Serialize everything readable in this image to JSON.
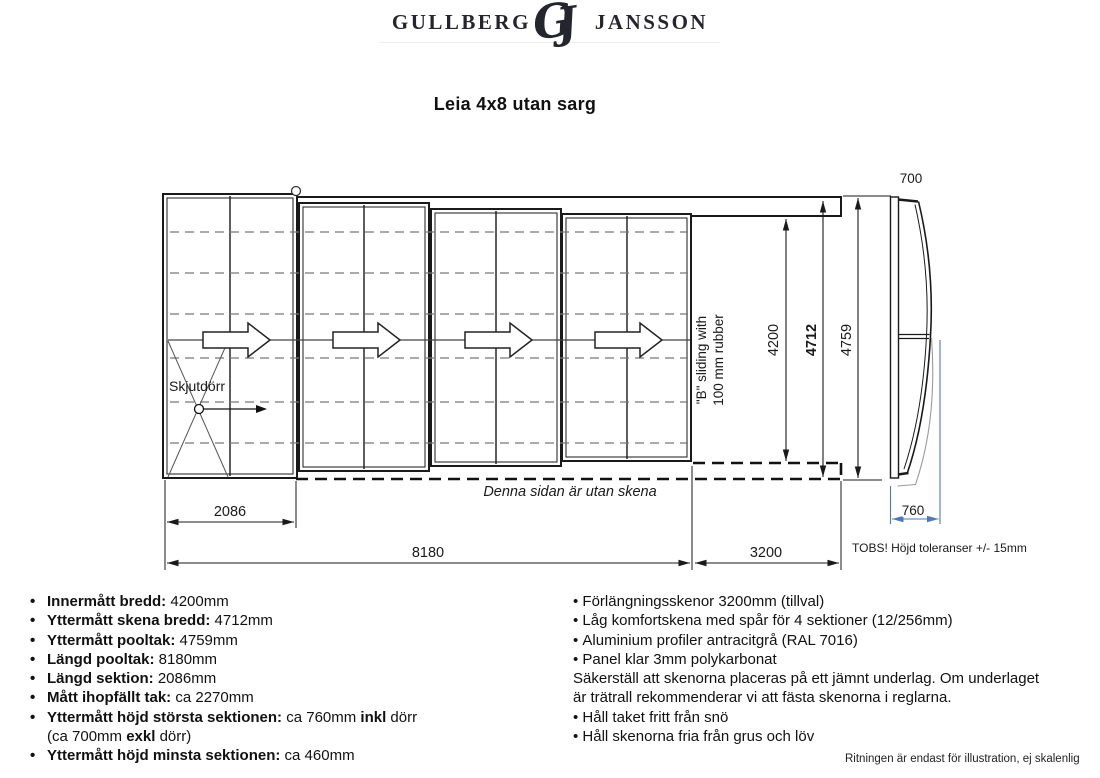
{
  "logo": {
    "word_left": "Gullberg",
    "monogram_g": "G",
    "monogram_j": "J",
    "word_right": "Jansson"
  },
  "title": "Leia 4x8 utan sarg",
  "drawing": {
    "labels": {
      "skjutdorr": "Skjutdörr",
      "denna_sidan": "Denna sidan är utan skena",
      "b_sliding_line1": "\"B\" sliding with",
      "b_sliding_line2": "100 mm rubber",
      "tobs": "TOBS! Höjd toleranser +/- 15mm"
    },
    "dimensions": {
      "inner_width": "4200",
      "rail_width": "4712",
      "outer_width": "4759",
      "section_length": "2086",
      "roof_length": "8180",
      "extension_length": "3200",
      "top_section_height": "700",
      "bottom_section_height": "760"
    },
    "colors": {
      "line": "#1a1a1a",
      "dash": "#777777",
      "blue": "#4d79b9",
      "gray": "#9a9a9a"
    }
  },
  "specs_left": [
    {
      "bullet": true,
      "segments": [
        {
          "t": "Innermått bredd:",
          "b": 1
        },
        {
          "t": " 4200mm"
        }
      ]
    },
    {
      "bullet": true,
      "segments": [
        {
          "t": "Yttermått skena bredd:",
          "b": 1
        },
        {
          "t": " 4712mm"
        }
      ]
    },
    {
      "bullet": true,
      "segments": [
        {
          "t": "Yttermått pooltak:",
          "b": 1
        },
        {
          "t": " 4759mm"
        }
      ]
    },
    {
      "bullet": true,
      "segments": [
        {
          "t": "Längd pooltak:",
          "b": 1
        },
        {
          "t": " 8180mm"
        }
      ]
    },
    {
      "bullet": true,
      "segments": [
        {
          "t": "Längd sektion:",
          "b": 1
        },
        {
          "t": " 2086mm"
        }
      ]
    },
    {
      "bullet": true,
      "segments": [
        {
          "t": "Mått ihopfällt tak:",
          "b": 1
        },
        {
          "t": " ca 2270mm"
        }
      ]
    },
    {
      "bullet": true,
      "segments": [
        {
          "t": "Yttermått höjd största sektionen:",
          "b": 1
        },
        {
          "t": " ca 760mm "
        },
        {
          "t": "inkl",
          "b": 1
        },
        {
          "t": " dörr"
        },
        {
          "br": 1
        },
        {
          "t": "(ca 700mm "
        },
        {
          "t": "exkl",
          "b": 1
        },
        {
          "t": " dörr)"
        }
      ]
    },
    {
      "bullet": true,
      "segments": [
        {
          "t": "Yttermått höjd minsta sektionen:",
          "b": 1
        },
        {
          "t": " ca 460mm"
        }
      ]
    }
  ],
  "notes_right": [
    {
      "bullet": true,
      "segments": [
        {
          "t": "Förlängningsskenor 3200mm (tillval)"
        }
      ]
    },
    {
      "bullet": true,
      "segments": [
        {
          "t": "Låg komfortskena med spår för 4 sektioner (12/256mm)"
        }
      ]
    },
    {
      "bullet": true,
      "segments": [
        {
          "t": "Aluminium profiler antracitgrå (RAL 7016)"
        }
      ]
    },
    {
      "bullet": true,
      "segments": [
        {
          "t": "Panel klar 3mm polykarbonat"
        }
      ]
    },
    {
      "bullet": false,
      "segments": [
        {
          "t": "Säkerställ att skenorna placeras på ett jämnt underlag. Om underlaget"
        },
        {
          "br": 1
        },
        {
          "t": "är trätrall rekommenderar vi att fästa skenorna i reglarna."
        }
      ]
    },
    {
      "bullet": true,
      "segments": [
        {
          "t": "Håll taket fritt från snö"
        }
      ]
    },
    {
      "bullet": true,
      "segments": [
        {
          "t": "Håll skenorna fria från grus och löv"
        }
      ]
    }
  ],
  "footer_note": "Ritningen är endast för illustration, ej skalenlig"
}
